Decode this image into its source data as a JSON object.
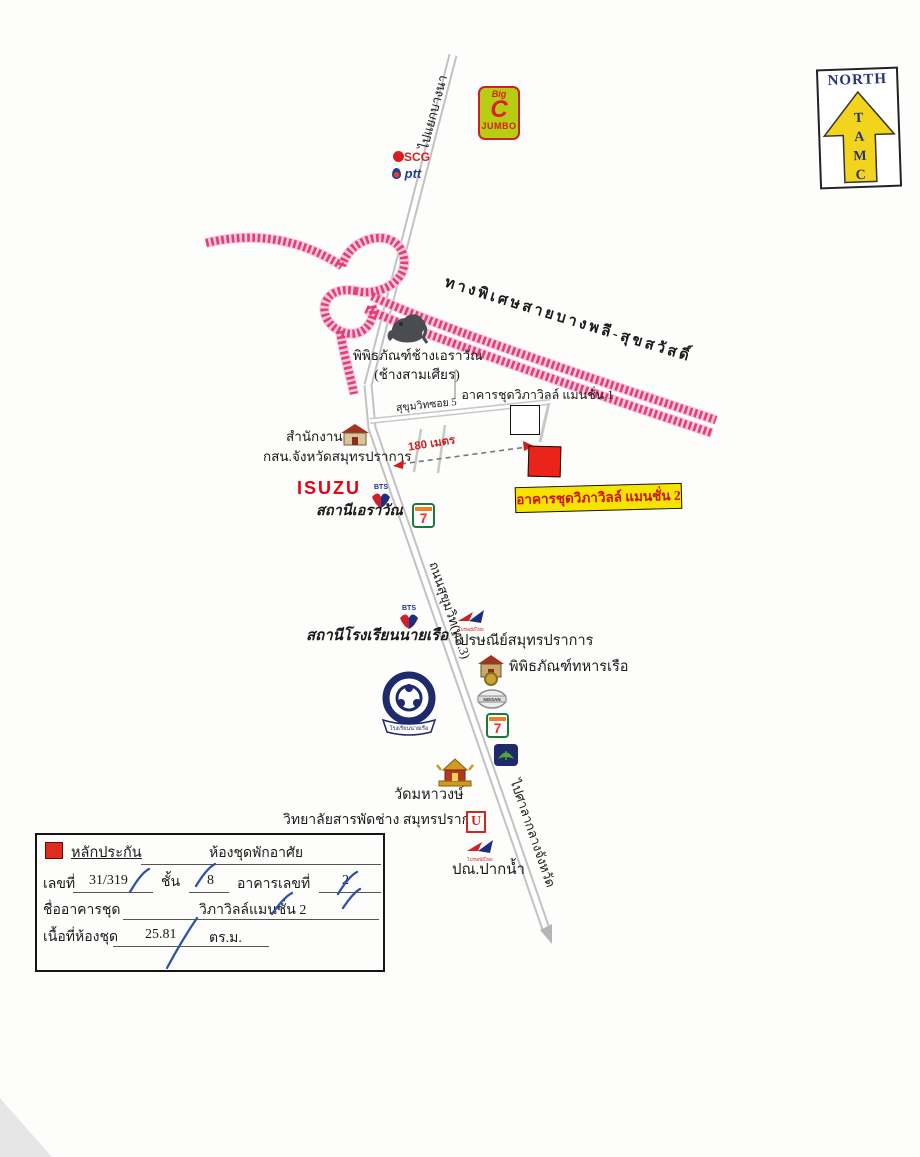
{
  "colors": {
    "expressway_pink": "#e23d7b",
    "highlight_yellow": "#f6e400",
    "marker_red": "#ea2418",
    "brand_red": "#e60012",
    "navy": "#26357f",
    "road_gray": "#c2c2c2",
    "handwriting_blue": "#2d52a8"
  },
  "north": {
    "title": "NORTH",
    "letters": [
      "T",
      "A",
      "M",
      "C"
    ]
  },
  "roads": {
    "to_bangna": "ไปแยกบางนา",
    "expressway": "ทางพิเศษสายบางพลี-สุขสวัสดิ์",
    "sukhumvit": "ถนนสุขุมวิท(ทล.3)",
    "soi5": "สุขุมวิทซอย 5",
    "to_city_hall": "ไปศาลากลางจังหวัด"
  },
  "logos": {
    "bigc_big": "Big",
    "bigc_c": "C",
    "bigc_jumbo": "JUMBO",
    "scg": "SCG",
    "ptt": "ptt",
    "isuzu": "ISUZU",
    "bts": "BTS",
    "seven": "7",
    "nissan": "NISSAN",
    "post_brand": "ไปรษณีย์ไทย",
    "college_u": "U"
  },
  "pois": {
    "erawan_museum_1": "พิพิธภัณฑ์ช้างเอราวัณ",
    "erawan_museum_2": "(ช้างสามเศียร)",
    "mansion1": "อาคารชุดวิภาวิลล์ แมนชั่น  1",
    "office_1": "สำนักงาน",
    "office_2": "กสน.จังหวัดสมุทรปราการ",
    "erawan_station": "สถานีเอราวัณ",
    "mansion2": "อาคารชุดวิภาวิลล์ แมนชั่น  2",
    "naval_station": "สถานีโรงเรียนนายเรือ",
    "post_office": "ไปรษณีย์สมุทรปราการ",
    "naval_museum": "พิพิธภัณฑ์ทหารเรือ",
    "naval_academy": "โรงเรียนนายเรือ",
    "temple": "วัดมหาวงษ์",
    "college": "วิทยาลัยสารพัดช่าง สมุทรปราการ",
    "paknam_post": "ปณ.ปากน้ำ"
  },
  "measure": {
    "distance": "180 เมตร"
  },
  "legend": {
    "title": "หลักประกัน",
    "type": "ห้องชุดพักอาศัย",
    "no_label": "เลขที่",
    "no_value": "31/319",
    "floor_label": "ชั้น",
    "floor_value": "8",
    "building_label": "อาคารเลขที่",
    "building_value": "2",
    "name_label": "ชื่ออาคารชุด",
    "name_value": "วิภาวิลล์แมนชั่น 2",
    "area_label": "เนื้อที่ห้องชุด",
    "area_value": "25.81",
    "area_unit": "ตร.ม."
  }
}
